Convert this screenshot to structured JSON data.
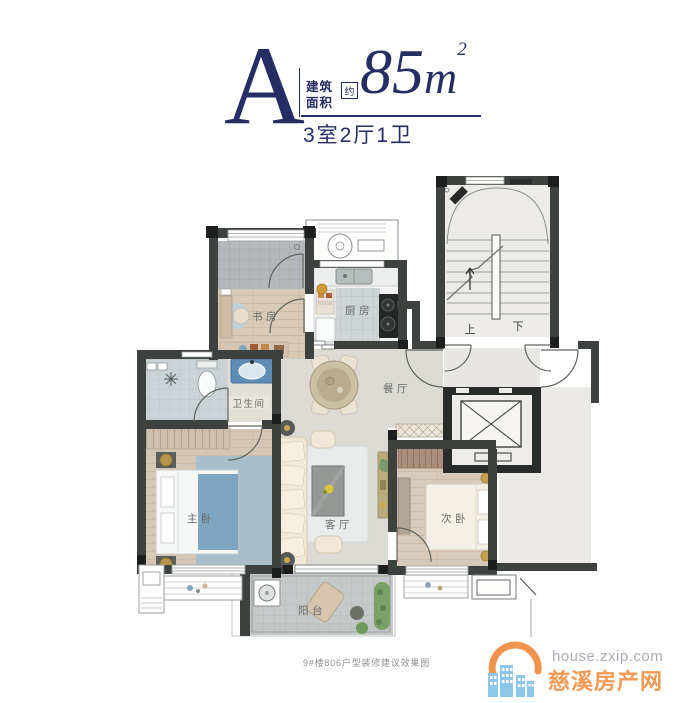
{
  "header": {
    "plan_letter": "A",
    "area_label_line1": "建筑",
    "area_label_line2": "面积",
    "approx_label": "约",
    "area_value": "85",
    "area_unit": "m",
    "area_exponent": "2",
    "layout_spec": "3室2厅1卫",
    "accent_color": "#252e63"
  },
  "plan": {
    "rooms": {
      "study": "书房",
      "kitchen": "厨房",
      "bathroom": "卫生间",
      "dining": "餐厅",
      "master_bedroom": "主卧",
      "living_room": "客厅",
      "second_bedroom": "次卧",
      "balcony": "阳台"
    },
    "stairs": {
      "up": "上",
      "down": "下"
    },
    "colors": {
      "wall": "#3d423e",
      "wall_post": "#1c1f1d",
      "wood_floor": "#d9c9b7",
      "hall_floor": "#dcdad4",
      "bath_tile": "#ccd3d7",
      "balcony_tile": "#c6c9c9",
      "accent_blue": "#7fa6c0"
    }
  },
  "caption": "9#楼806户型装修建议效果图",
  "watermark": {
    "site_url": "house.zxip.com",
    "site_name": "慈溪房产网",
    "logo_blue": "#8cc6e9",
    "logo_orange": "#f0944d",
    "url_color": "#a9aeb4",
    "name_color": "#f29a56"
  }
}
